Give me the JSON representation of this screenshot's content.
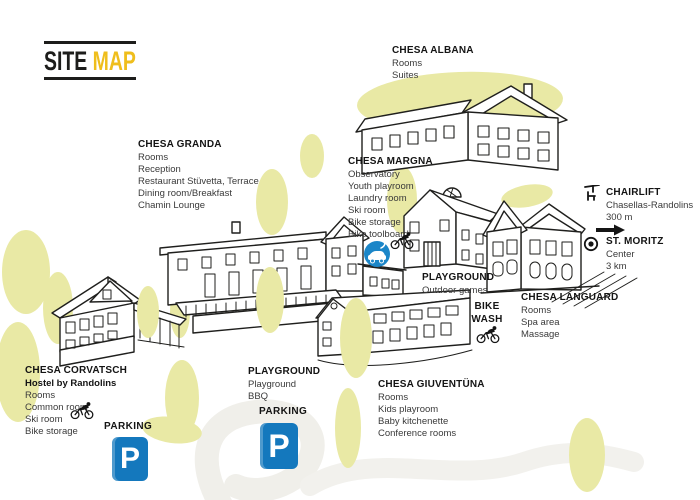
{
  "title": {
    "word1": "SITE",
    "word2": "MAP"
  },
  "colors": {
    "accent_yellow": "#EFBE1C",
    "parking_blue": "#1478BD",
    "ev_charger_blue": "#1B86C8",
    "tree_yellow_green": "#E9E9A5",
    "road_gray": "#F0EFEA",
    "ink": "#1D1D1B"
  },
  "locations": {
    "chesa_albana": {
      "name": "CHESA ALBANA",
      "features": [
        "Rooms",
        "Suites"
      ]
    },
    "chesa_granda": {
      "name": "CHESA GRANDA",
      "features": [
        "Rooms",
        "Reception",
        "Restaurant Stüvetta, Terrace",
        "Dining room/Breakfast",
        "Chamin Lounge"
      ]
    },
    "chesa_margna": {
      "name": "CHESA MARGNA",
      "features": [
        "Observatory",
        "Youth playroom",
        "Laundry room",
        "Ski room",
        "Bike storage",
        "Bike toolboard"
      ]
    },
    "chesa_languard": {
      "name": "CHESA LANGUARD",
      "features": [
        "Rooms",
        "Spa area",
        "Massage"
      ]
    },
    "chesa_giuventuna": {
      "name": "CHESA GIUVENTÜNA",
      "features": [
        "Rooms",
        "Kids playroom",
        "Baby kitchenette",
        "Conference rooms"
      ]
    },
    "chesa_corvatsch": {
      "name": "CHESA CORVATSCH",
      "subtitle": "Hostel by Randolins",
      "features": [
        "Rooms",
        "Common room",
        "Ski room",
        "Bike storage"
      ]
    },
    "playground_upper": {
      "name": "PLAYGROUND",
      "features": [
        "Outdoor games"
      ]
    },
    "playground_lower": {
      "name": "PLAYGROUND",
      "features": [
        "Playground",
        "BBQ"
      ]
    },
    "bike_wash": {
      "line1": "BIKE",
      "line2": "WASH"
    },
    "chairlift": {
      "name": "CHAIRLIFT",
      "features": [
        "Chasellas-Randolins",
        "300 m"
      ]
    },
    "st_moritz": {
      "name": "ST. MORITZ",
      "features": [
        "Center",
        "3 km"
      ]
    },
    "parking_west": {
      "name": "PARKING",
      "sign": "P"
    },
    "parking_central": {
      "name": "PARKING",
      "sign": "P"
    }
  }
}
